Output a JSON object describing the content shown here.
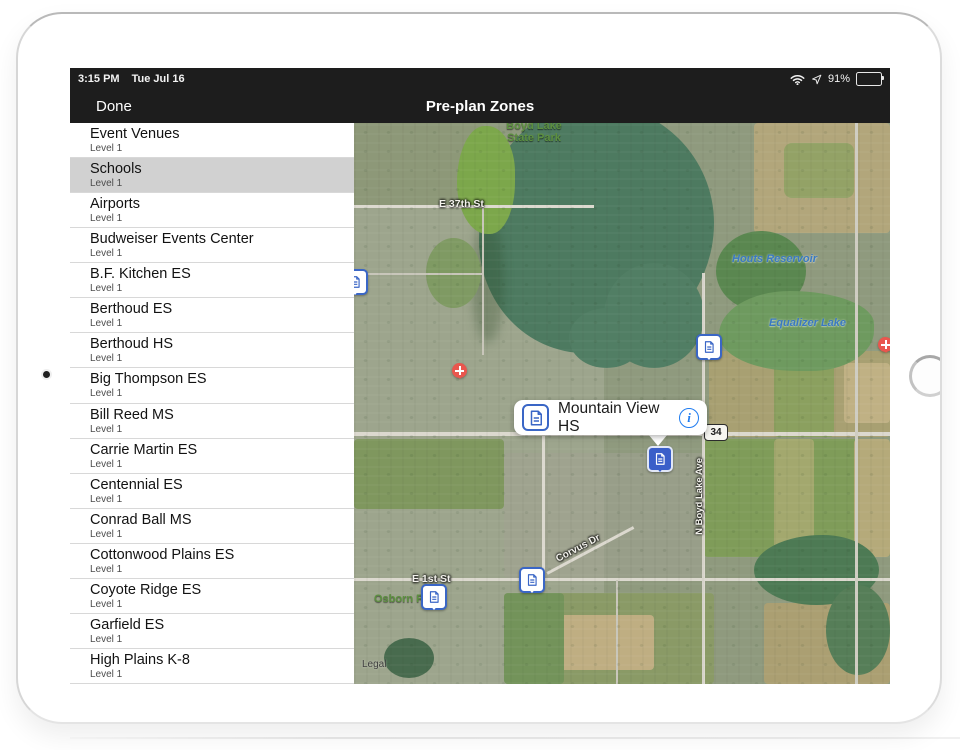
{
  "device": {
    "time": "3:15 PM",
    "date": "Tue Jul 16",
    "battery": "91%"
  },
  "nav": {
    "done_label": "Done",
    "title": "Pre-plan Zones"
  },
  "list": {
    "items": [
      {
        "title": "Event Venues",
        "subtitle": "Level 1",
        "selected": false
      },
      {
        "title": "Schools",
        "subtitle": "Level 1",
        "selected": true
      },
      {
        "title": "Airports",
        "subtitle": "Level 1",
        "selected": false
      },
      {
        "title": "Budweiser Events Center",
        "subtitle": "Level 1",
        "selected": false
      },
      {
        "title": "B.F. Kitchen ES",
        "subtitle": "Level 1",
        "selected": false
      },
      {
        "title": "Berthoud ES",
        "subtitle": "Level 1",
        "selected": false
      },
      {
        "title": "Berthoud HS",
        "subtitle": "Level 1",
        "selected": false
      },
      {
        "title": "Big Thompson ES",
        "subtitle": "Level 1",
        "selected": false
      },
      {
        "title": "Bill Reed MS",
        "subtitle": "Level 1",
        "selected": false
      },
      {
        "title": "Carrie Martin ES",
        "subtitle": "Level 1",
        "selected": false
      },
      {
        "title": "Centennial ES",
        "subtitle": "Level 1",
        "selected": false
      },
      {
        "title": "Conrad Ball MS",
        "subtitle": "Level 1",
        "selected": false
      },
      {
        "title": "Cottonwood Plains ES",
        "subtitle": "Level 1",
        "selected": false
      },
      {
        "title": "Coyote Ridge ES",
        "subtitle": "Level 1",
        "selected": false
      },
      {
        "title": "Garfield ES",
        "subtitle": "Level 1",
        "selected": false
      },
      {
        "title": "High Plains K-8",
        "subtitle": "Level 1",
        "selected": false
      }
    ]
  },
  "map": {
    "park_label": {
      "line1": "Boyd Lake",
      "line2": "State Park"
    },
    "water": {
      "houts": "Houts Reservoir",
      "equalizer": "Equalizer Lake"
    },
    "streets": {
      "e37th": "E 37th St",
      "e1st": "E 1st St",
      "boyd_ave": "N Boyd Lake Ave",
      "corvus": "Corvus Dr"
    },
    "route_shield": "34",
    "poi": {
      "osborn": "Osborn Park"
    },
    "legal": "Legal",
    "callout": {
      "title": "Mountain View HS"
    }
  },
  "icons": {
    "status": [
      "wifi-icon",
      "location-arrow-icon",
      "battery-icon"
    ],
    "pin": "preplan-document-icon",
    "callout": "info-icon",
    "medical": "hospital-cross-icon"
  },
  "colors": {
    "navbar": "#1d1d1d",
    "selected_row": "#d1d1d1",
    "pin_blue": "#3a66c6",
    "selected_pin_blue": "#3a5fc9",
    "info_blue": "#1f7cf0",
    "water_label": "#3a79c2",
    "park_label": "#5d9040",
    "medical_red": "#e9564e"
  }
}
